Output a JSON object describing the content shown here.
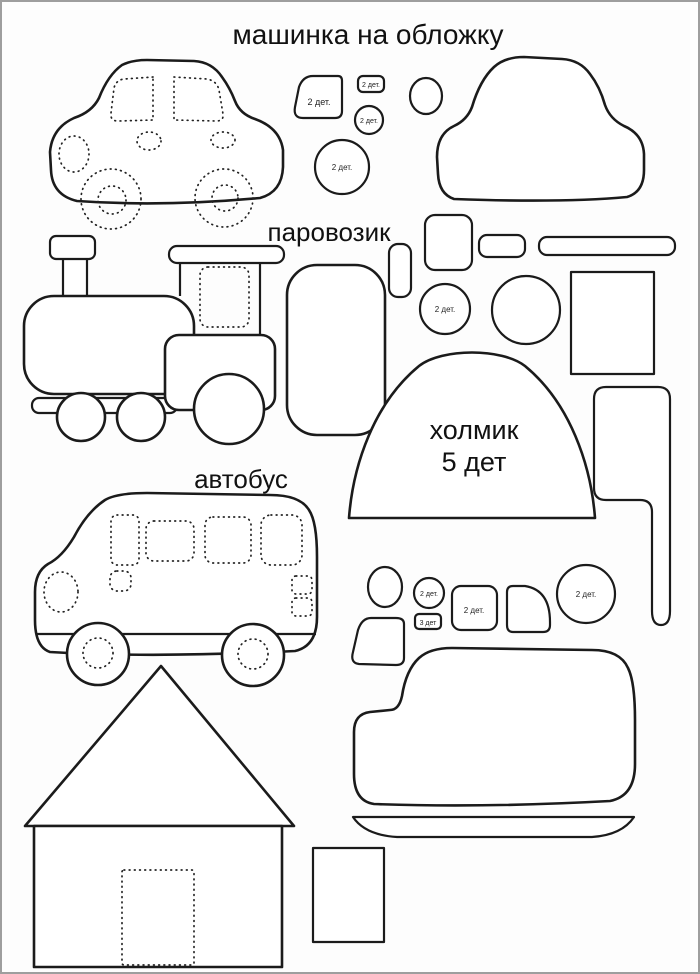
{
  "page": {
    "background": "#fdfdfd",
    "border_color": "#9e9e9e",
    "line_color": "#1b1b1b",
    "text_color": "#111111"
  },
  "sections": {
    "cover_car": {
      "title": "машинка на обложку"
    },
    "train": {
      "title": "паровозик",
      "circle_label": "2 дет."
    },
    "hill": {
      "name": "холмик",
      "count": "5 дет"
    },
    "bus": {
      "title": "автобус"
    }
  },
  "top_pieces": {
    "window_label": "2 дет.",
    "tab_label": "2 дет.",
    "small_circle_label": "2 дет.",
    "big_circle_label": "2 дет."
  },
  "bottom_pieces": {
    "small_circle_label": "2 дет.",
    "tab_label": "3 дет",
    "square_label": "2 дет.",
    "big_circle_label": "2 дет."
  }
}
